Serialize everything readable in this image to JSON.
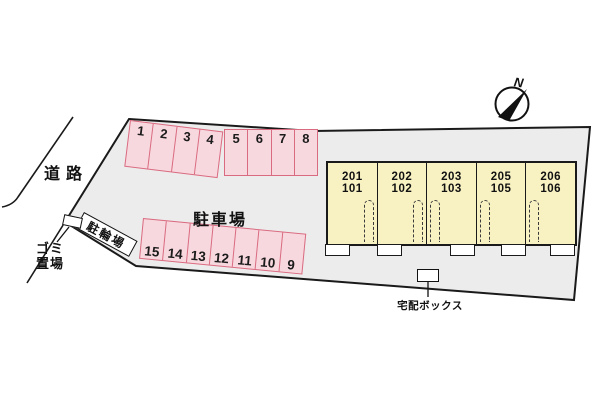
{
  "site": {
    "road_label": "道路",
    "parking_lot_label": "駐車場",
    "bicycle_parking_label": "駐輪場",
    "garbage_label_line1": "ゴミ",
    "garbage_label_line2": "置場",
    "delivery_box_label": "宅配ボックス",
    "compass_letter": "N"
  },
  "parking_spaces": {
    "top_row_left": [
      "1",
      "2",
      "3",
      "4"
    ],
    "top_row_right": [
      "5",
      "6",
      "7",
      "8"
    ],
    "bottom_row": [
      "15",
      "14",
      "13",
      "12",
      "11",
      "10",
      "9"
    ]
  },
  "building_units": [
    {
      "upper": "201",
      "lower": "101"
    },
    {
      "upper": "202",
      "lower": "102"
    },
    {
      "upper": "203",
      "lower": "103"
    },
    {
      "upper": "205",
      "lower": "105"
    },
    {
      "upper": "206",
      "lower": "106"
    }
  ],
  "colors": {
    "site_fill": "#ececec",
    "parking_space_fill": "#f8d8df",
    "parking_space_border": "#d96b80",
    "building_fill": "#f8f2c3",
    "outline": "#1a1a1a"
  }
}
